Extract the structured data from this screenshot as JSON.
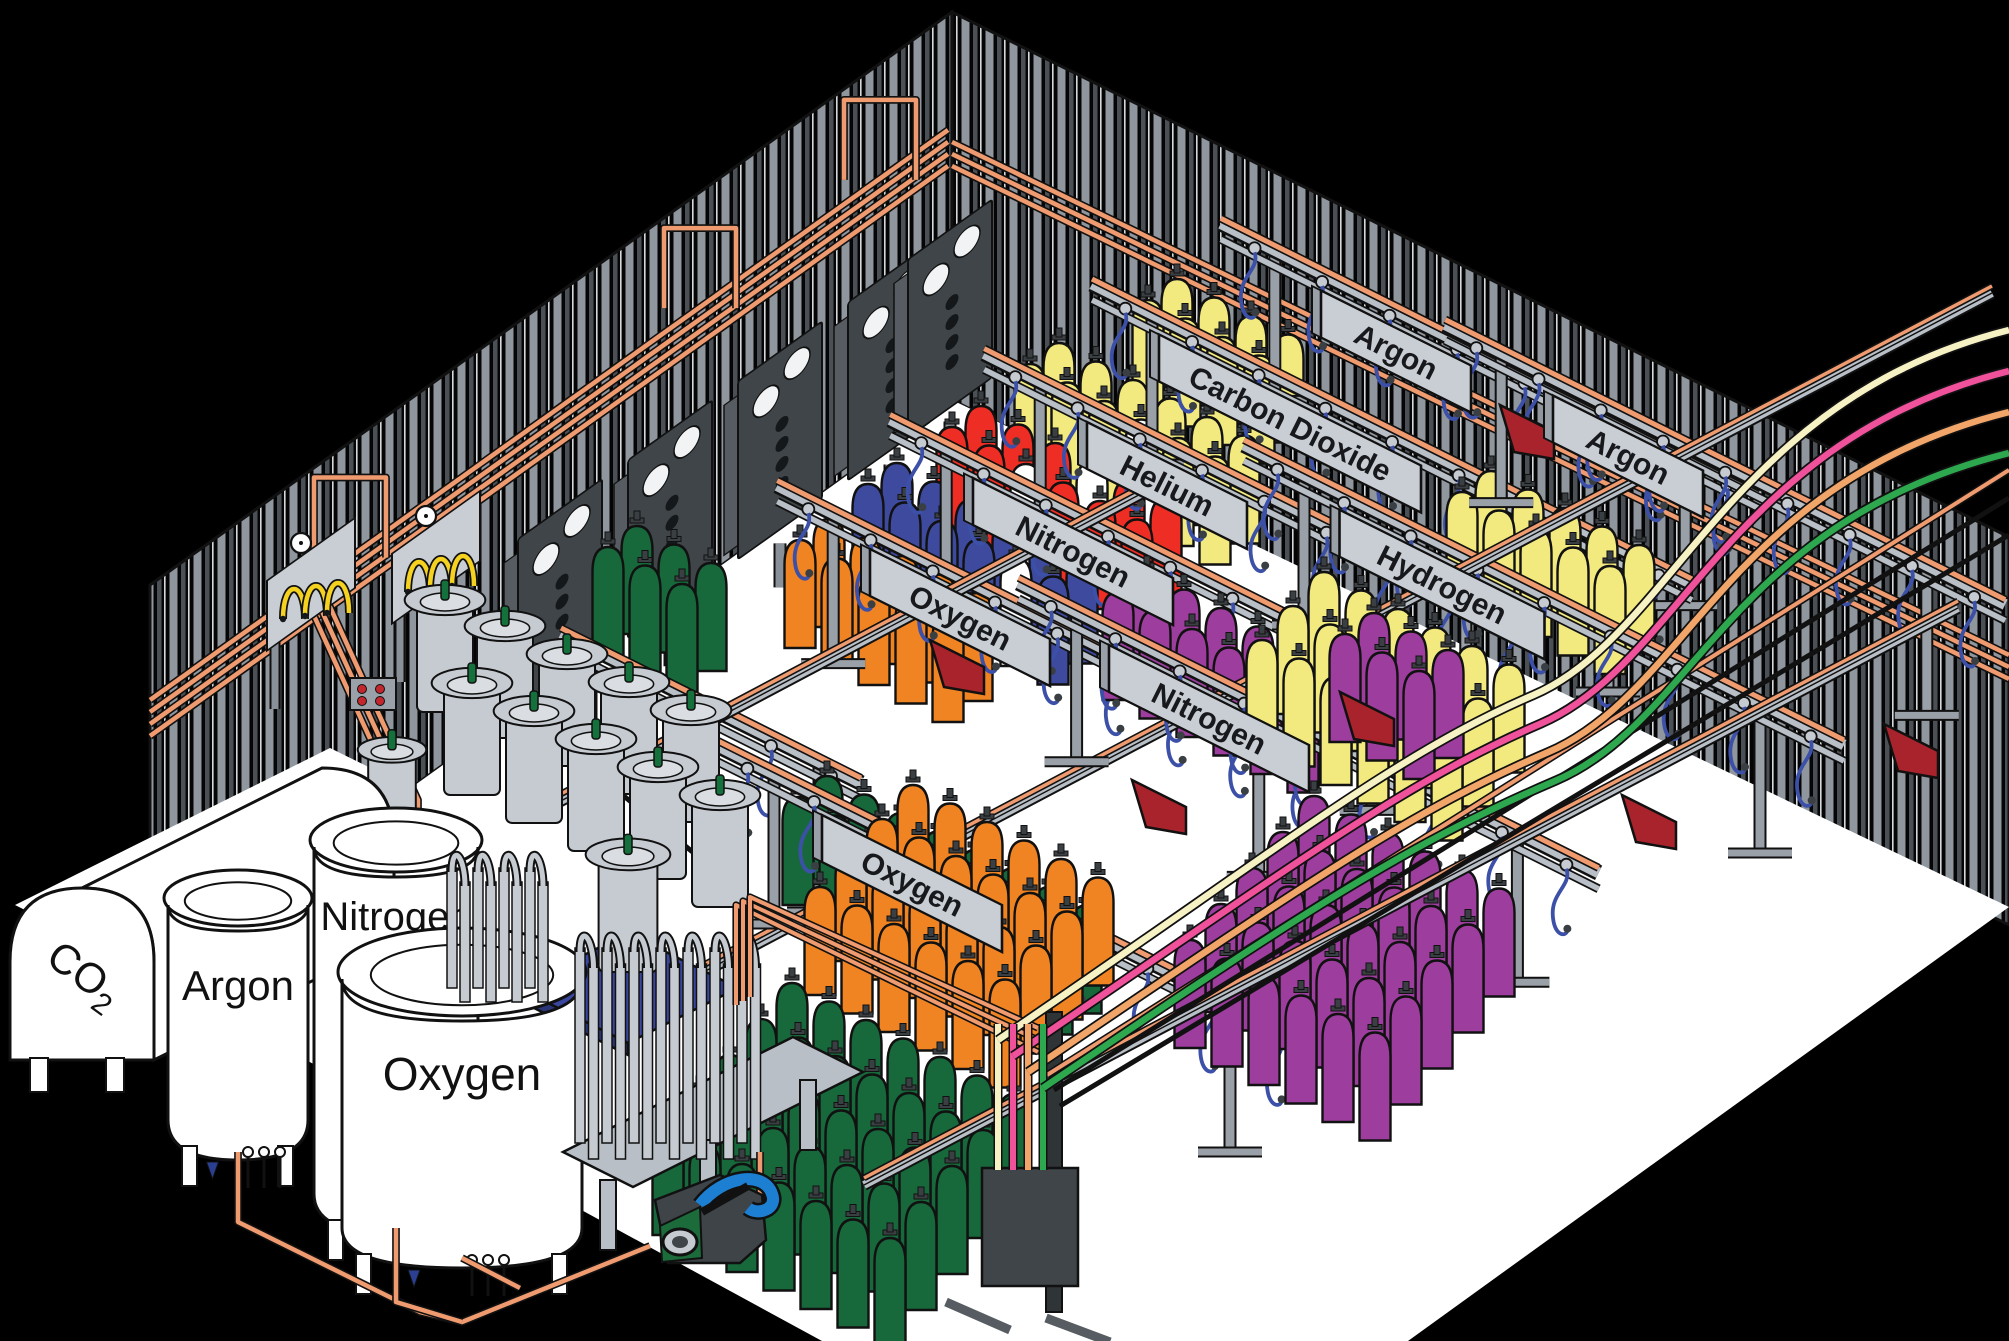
{
  "scene": {
    "description": "Isometric illustration of an industrial gas cylinder filling plant",
    "colors": {
      "background": "#000000",
      "wall_stripe": "#8F969E",
      "floor": "#FFFFFF",
      "copper_pipe": "#EF9B6F",
      "rail_gray": "#B9BFC6",
      "panel_dark": "#3F4549",
      "sign_plate": "#C9CED5",
      "sign_text": "#17191C",
      "hose_blue": "#3C50A8",
      "cart_red": "#A8232B",
      "scale_blue": "#3A47A0",
      "dewar_gray": "#C6CBD1",
      "pigtail_yellow": "#F5D120",
      "pump_green": "#1C6B3A",
      "pump_hose_blue": "#1D7FD1"
    },
    "signs": [
      {
        "label": "Oxygen",
        "x": 960,
        "y": 618,
        "w": 180,
        "rail_len": 560
      },
      {
        "label": "Nitrogen",
        "x": 1073,
        "y": 552,
        "w": 200,
        "rail_len": 560
      },
      {
        "label": "Helium",
        "x": 1167,
        "y": 486,
        "w": 160,
        "rail_len": 560
      },
      {
        "label": "Carbon Dioxide",
        "x": 1290,
        "y": 424,
        "w": 262,
        "rail_len": 600
      },
      {
        "label": "Argon",
        "x": 1396,
        "y": 352,
        "w": 150,
        "rail_len": 540
      },
      {
        "label": "Hydrogen",
        "x": 1442,
        "y": 585,
        "w": 205,
        "rail_len": 600
      },
      {
        "label": "Argon",
        "x": 1628,
        "y": 457,
        "w": 150,
        "rail_len": 560
      },
      {
        "label": "Nitrogen",
        "x": 1209,
        "y": 719,
        "w": 200,
        "rail_len": 580
      },
      {
        "label": "Oxygen",
        "x": 912,
        "y": 884,
        "w": 180,
        "rail_len": 600
      }
    ],
    "extra_rails": [
      {
        "x": 675,
        "y": 690,
        "len": 300
      }
    ],
    "tanks": [
      {
        "label": "CO2",
        "type": "horizontal-tank"
      },
      {
        "label": "Argon",
        "type": "vertical-tank"
      },
      {
        "label": "Nitrogen",
        "type": "vertical-tank"
      },
      {
        "label": "Oxygen",
        "type": "vertical-tank"
      }
    ],
    "cylinder_groups": [
      {
        "name": "argon-top",
        "gas": "Argon",
        "color": "#F2E97F",
        "x": 1148,
        "y": 408,
        "cols": 4,
        "rows": 2
      },
      {
        "name": "carbon-dioxide",
        "gas": "Carbon Dioxide",
        "color": "#F2E97F",
        "x": 1030,
        "y": 472,
        "cols": 6,
        "rows": 2,
        "whites": [
          3
        ]
      },
      {
        "name": "helium",
        "gas": "Helium",
        "color": "#EE2E24",
        "x": 952,
        "y": 535,
        "cols": 6,
        "rows": 2,
        "whites": [
          2,
          9
        ]
      },
      {
        "name": "nitrogen-back",
        "gas": "Nitrogen",
        "color": "#3D4A9E",
        "x": 868,
        "y": 592,
        "cols": 6,
        "rows": 2,
        "whites": [
          4
        ]
      },
      {
        "name": "oxygen-back",
        "gas": "Oxygen",
        "color": "#F08423",
        "x": 800,
        "y": 648,
        "cols": 5,
        "rows": 2
      },
      {
        "name": "green-back",
        "gas": "Oxygen",
        "color": "#17693B",
        "x": 608,
        "y": 655,
        "cols": 3,
        "rows": 2
      },
      {
        "name": "argon-2",
        "gas": "Argon",
        "color": "#F2E97F",
        "x": 1462,
        "y": 600,
        "cols": 5,
        "rows": 2
      },
      {
        "name": "hydrogen",
        "gas": "Hydrogen",
        "color": "#9D3D9D",
        "x": 1118,
        "y": 700,
        "cols": 6,
        "rows": 2
      },
      {
        "name": "oxygen-line",
        "gas": "Oxygen",
        "color": "#17693B",
        "x": 798,
        "y": 905,
        "cols": 8,
        "rows": 2
      },
      {
        "name": "nitrogen-crowd",
        "gas": "Nitrogen",
        "color": "#F08423",
        "x": 820,
        "y": 995,
        "cols": 6,
        "rows": 4,
        "vx": 31,
        "vy": -34
      },
      {
        "name": "oxygen-crowd",
        "gas": "Oxygen",
        "color": "#17693B",
        "x": 668,
        "y": 1235,
        "cols": 7,
        "rows": 5,
        "vx": 31,
        "vy": -36
      },
      {
        "name": "argon-crowd",
        "gas": "Argon",
        "color": "#F2E97F",
        "x": 1262,
        "y": 748,
        "cols": 6,
        "rows": 3,
        "vx": 31,
        "vy": -34
      },
      {
        "name": "hydrogen-right",
        "gas": "Hydrogen",
        "color": "#9D3D9D",
        "x": 1345,
        "y": 742,
        "cols": 3,
        "rows": 2
      },
      {
        "name": "hydrogen-crowd",
        "gas": "Hydrogen",
        "color": "#9D3D9D",
        "x": 1190,
        "y": 1048,
        "cols": 6,
        "rows": 5,
        "vx": 31,
        "vy": -36
      }
    ],
    "fill_hose_colors": [
      "#F7F2C4",
      "#F0519B",
      "#F2A569",
      "#2EA84F"
    ],
    "carts": [
      [
        930,
        640
      ],
      [
        1500,
        405
      ],
      [
        1340,
        692
      ],
      [
        1132,
        780
      ],
      [
        1622,
        795
      ],
      [
        1884,
        724
      ]
    ],
    "tracks": [
      [
        [
          540,
          812
        ],
        [
          1152,
          488
        ]
      ],
      [
        [
          622,
          1015
        ],
        [
          1992,
          293
        ]
      ],
      [
        [
          864,
          1185
        ],
        [
          1958,
          608
        ]
      ]
    ],
    "wall_panels": [
      560,
      670,
      780,
      890,
      950
    ],
    "dewars": [
      [
        445,
        712
      ],
      [
        505,
        738
      ],
      [
        567,
        766
      ],
      [
        629,
        794
      ],
      [
        691,
        822
      ],
      [
        472,
        795
      ],
      [
        534,
        823
      ],
      [
        596,
        851
      ],
      [
        658,
        879
      ],
      [
        720,
        907
      ],
      [
        392,
        845
      ]
    ],
    "pigtail_stations": [
      [
        303,
        703
      ],
      [
        428,
        676
      ]
    ]
  }
}
